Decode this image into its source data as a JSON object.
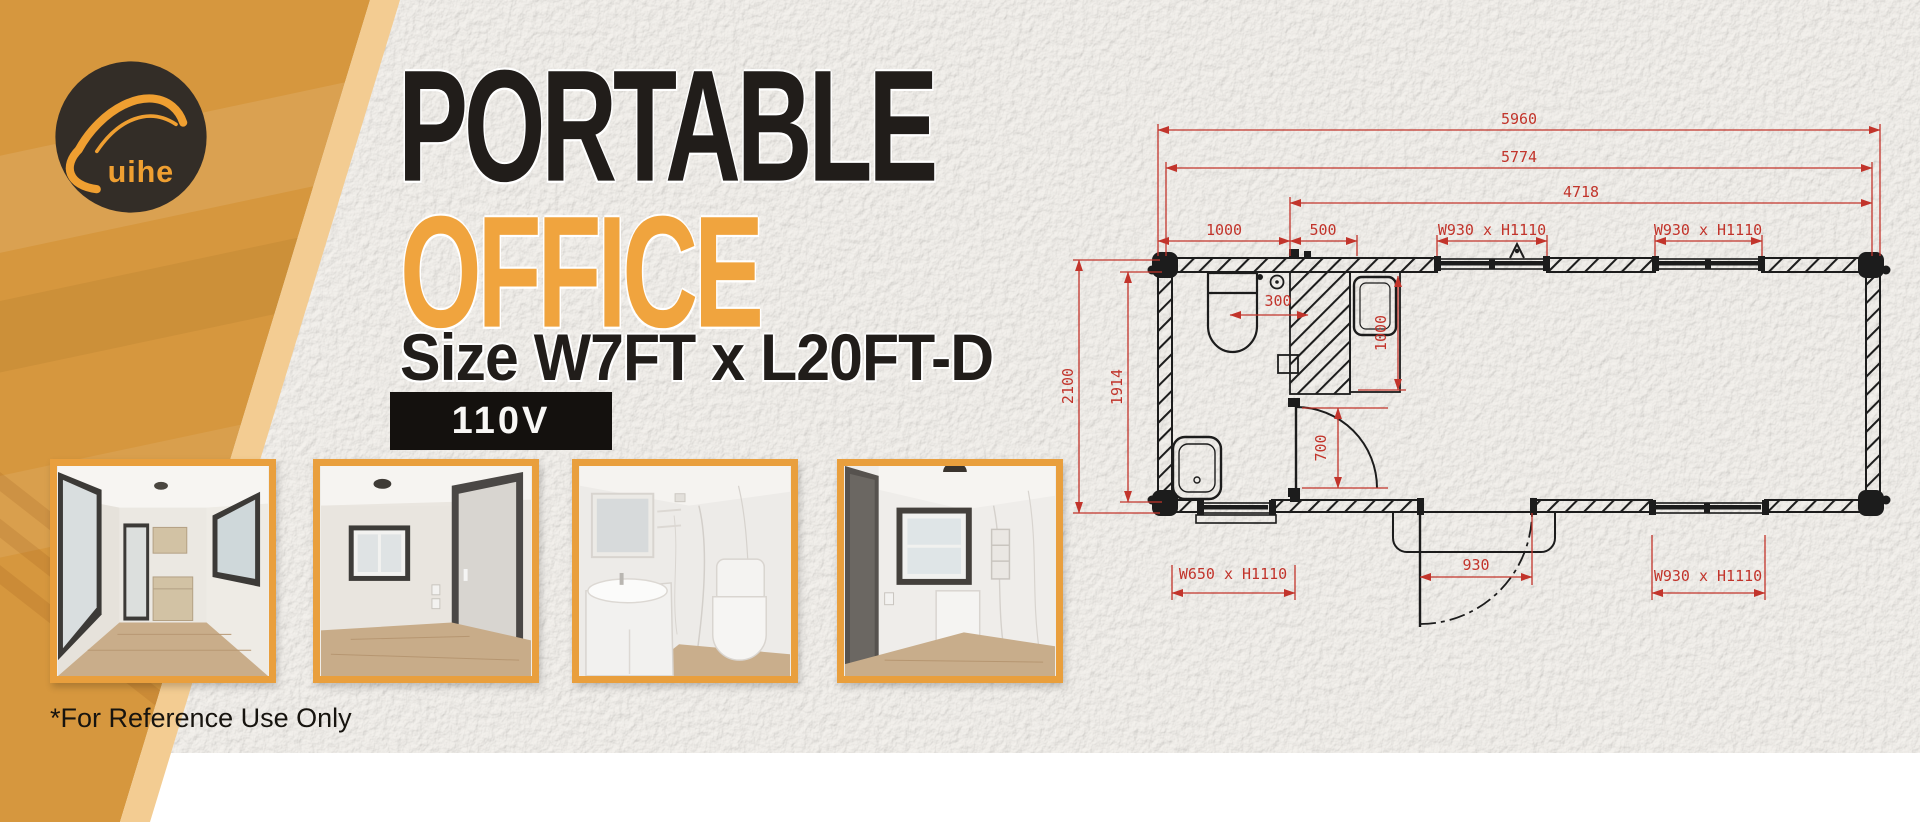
{
  "brand": {
    "name": "Suihe"
  },
  "headline": {
    "line1": "PORTABLE",
    "line2": "OFFICE",
    "size_line": "Size W7FT x L20FT-D",
    "voltage_badge": "110V"
  },
  "footnote": "*For Reference Use Only",
  "thumbnails": [
    {
      "alt": "Office interior with side windows, cabinets and wood floor"
    },
    {
      "alt": "Empty office room with window and entry door"
    },
    {
      "alt": "Bathroom with vanity sink, mirror and toilet"
    },
    {
      "alt": "Bathroom corner with window and wall cabinet"
    }
  ],
  "floor_plan": {
    "dims_top": {
      "overall": "5960",
      "frame": "5774",
      "main_room": "4718",
      "bath_width": "1000",
      "utility_width": "500",
      "window_top_1": "W930 x H1110",
      "window_top_2": "W930 x H1110"
    },
    "dims_left": {
      "overall": "2100",
      "interior": "1914"
    },
    "dims_interior": {
      "toilet_offset": "300",
      "counter_depth": "1000",
      "bath_door_width": "700"
    },
    "dims_bottom": {
      "window_bath": "W650 x H1110",
      "entry_door_width": "930",
      "window_right": "W930 x H1110"
    },
    "colors": {
      "dimension_red": "#c2342b",
      "line_black": "#1c1c1c"
    }
  },
  "colors": {
    "wedge_orange": "#d6973e",
    "wedge_light": "#f3cc92",
    "accent_orange": "#f0a43e",
    "badge_bg": "#14110e",
    "text_dark": "#211d1a"
  }
}
